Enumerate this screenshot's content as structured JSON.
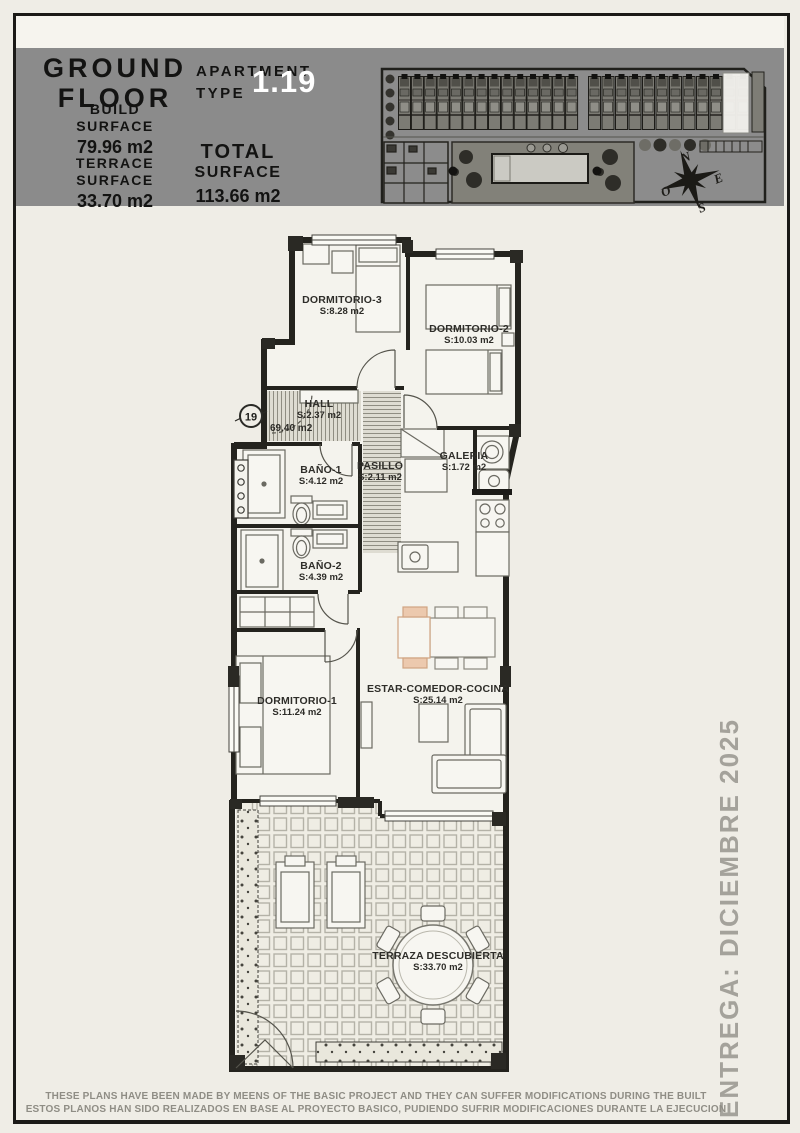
{
  "header": {
    "floor": {
      "line1": "GROUND",
      "line2": "FLOOR"
    },
    "apartment": {
      "label_line1": "APARTMENT",
      "label_line2": "TYPE",
      "number": "1.19"
    },
    "build": {
      "label1": "BUILD",
      "label2": "SURFACE",
      "value": "79.96 m2"
    },
    "terrace": {
      "label1": "TERRACE",
      "label2": "SURFACE",
      "value": "33.70 m2"
    },
    "total": {
      "label1": "TOTAL",
      "label2": "SURFACE",
      "value": "113.66 m2"
    }
  },
  "compass": {
    "north": "N",
    "east": "E",
    "south": "S",
    "west": "O"
  },
  "plan": {
    "unit_number": "19",
    "unit_area": "69.40 m2",
    "rooms": [
      {
        "name": "DORMITORIO-3",
        "area": "S:8.28 m2"
      },
      {
        "name": "DORMITORIO-2",
        "area": "S:10.03 m2"
      },
      {
        "name": "HALL",
        "area": "S:2.37 m2"
      },
      {
        "name": "PASILLO",
        "area": "S:2.11 m2"
      },
      {
        "name": "GALERIA",
        "area": "S:1.72 m2"
      },
      {
        "name": "BAÑO-1",
        "area": "S:4.12 m2"
      },
      {
        "name": "BAÑO-2",
        "area": "S:4.39 m2"
      },
      {
        "name": "DORMITORIO-1",
        "area": "S:11.24 m2"
      },
      {
        "name": "ESTAR-COMEDOR-COCINA",
        "area": "S:25.14 m2"
      },
      {
        "name": "TERRAZA DESCUBIERTA",
        "area": "S:33.70 m2"
      }
    ]
  },
  "delivery_note": "ENTREGA: DICIEMBRE 2025",
  "footer": {
    "line1": "THESE PLANS HAVE BEEN MADE BY MEENS OF THE BASIC PROJECT AND THEY CAN SUFFER MODIFICATIONS DURING THE BUILT",
    "line2": "ESTOS PLANOS HAN SIDO REALIZADOS EN BASE AL PROYECTO BASICO, PUDIENDO SUFRIR MODIFICACIONES DURANTE LA EJECUCION"
  },
  "colors": {
    "header_band": "#8b8b8b",
    "apartment_number": "#ffffff",
    "wall": "#24231e",
    "plan_text": "#2e2d29",
    "delivery_text": "#a4a29b",
    "footer_text": "#8f8d85",
    "accent_chair": "#ecc9ae"
  }
}
